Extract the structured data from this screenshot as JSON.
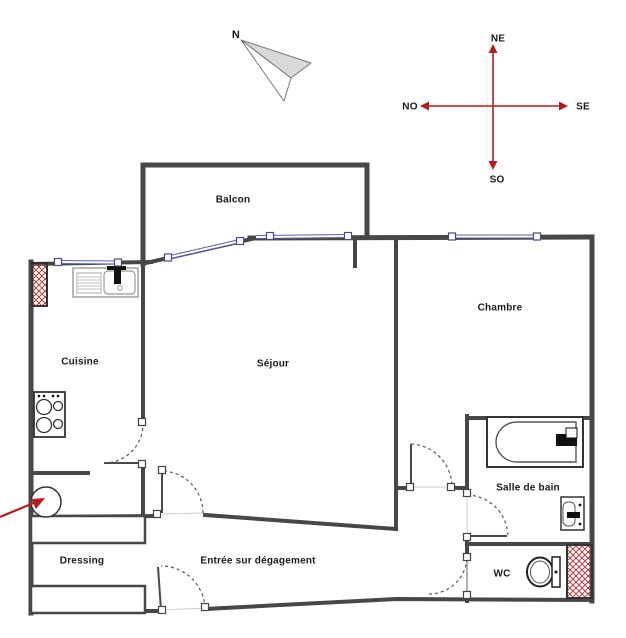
{
  "document_type": "apartment floor plan drawing",
  "north_indicator": {
    "label": "N"
  },
  "compass": {
    "top": "NE",
    "right": "SE",
    "bottom": "SO",
    "left": "NO",
    "arrow_color": "#b01e1e"
  },
  "rooms": {
    "balcon": "Balcon",
    "cuisine": "Cuisine",
    "sejour": "Séjour",
    "chambre": "Chambre",
    "salle_de_bain": "Salle de bain",
    "dressing": "Dressing",
    "entree": "Entrée sur dégagement",
    "wc": "WC"
  },
  "fixtures": [
    "bathtub",
    "toilet",
    "washbasin",
    "kitchen-sink",
    "stove-top",
    "water-heater",
    "wardrobe",
    "duct-shaft"
  ],
  "colors": {
    "wall": "#474747",
    "window": "#5b5bb5",
    "duct_hatch": "#b84040",
    "annotation_red": "#b01e1e",
    "text": "#1a1a1a"
  }
}
